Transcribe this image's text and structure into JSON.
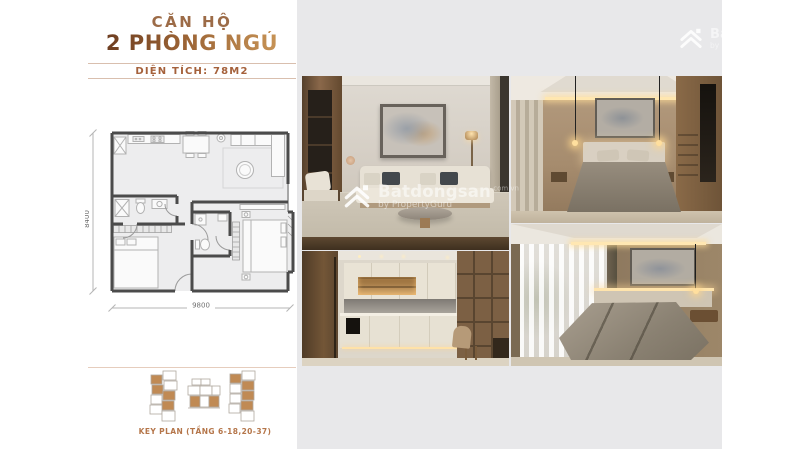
{
  "header": {
    "title_line1": "CĂN HỘ",
    "title_line2": "2 PHÒNG NGỦ",
    "area_label": "DIỆN TÍCH: 78M2"
  },
  "floor_plan": {
    "height_dim": "8400",
    "width_dim": "9800"
  },
  "key_plan": {
    "label": "KEY PLAN (TẦNG 6-18,20-37)"
  },
  "watermark": {
    "brand": "Batdongsan",
    "suffix": ".com.vn",
    "byline": "by PropertyGuru"
  },
  "colors": {
    "canvas_bg": "#e8e8ea",
    "title_gradient_dark": "#63351c",
    "title_gradient_light": "#cf9c5c",
    "title_small": "#9c6b47",
    "accent_text": "#a5613b",
    "divider": "#d9bfae",
    "keyplan_label": "#b5764a",
    "keyplan_unit_fill": "#c08a54",
    "plan_wall": "#4b4b4b"
  }
}
